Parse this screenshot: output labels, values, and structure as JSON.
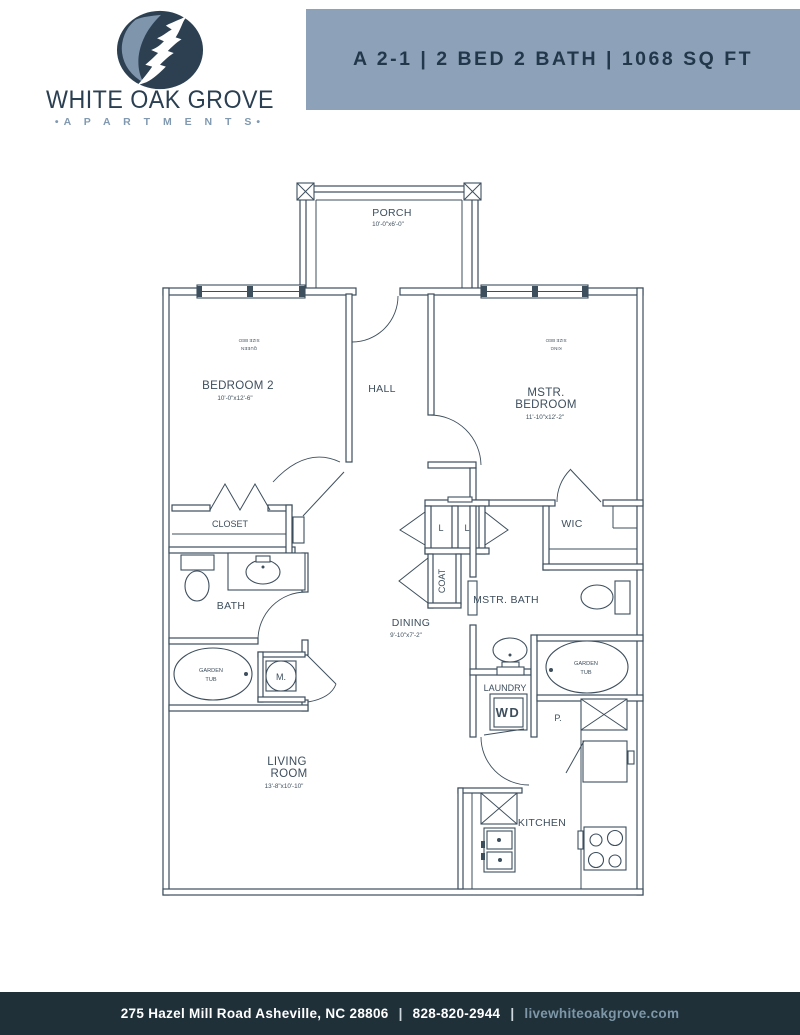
{
  "header": {
    "logo": {
      "name_line": "WHITE OAK GROVE",
      "sub_line": "•A P A R T M E N T S•",
      "name_color": "#2b3f52",
      "sub_color": "#8099b0",
      "leaf_dark": "#2c4052",
      "leaf_light": "#7f95ac"
    },
    "banner": {
      "title": "A 2-1 | 2 BED 2 BATH | 1068 SQ FT",
      "bg_color": "#8da1b8",
      "text_color": "#22384a"
    }
  },
  "floorplan": {
    "line_color": "#3d4e5d",
    "porch": {
      "label": "PORCH",
      "dims": "10'-0\"x6'-0\""
    },
    "bedroom2": {
      "label": "BEDROOM 2",
      "dims": "10'-0\"x12'-6\"",
      "bed_note_line1": "SIZE BED",
      "bed_note_line2": "QUEEN"
    },
    "mstr_bedroom": {
      "label_line1": "MSTR.",
      "label_line2": "BEDROOM",
      "dims": "11'-10\"x12'-2\"",
      "bed_note_line1": "SIZE BED",
      "bed_note_line2": "KING"
    },
    "hall": {
      "label": "HALL"
    },
    "closet": {
      "label": "CLOSET"
    },
    "bath": {
      "label": "BATH"
    },
    "dining": {
      "label": "DINING",
      "dims": "9'-10\"x7'-2\""
    },
    "living_room": {
      "label_line1": "LIVING",
      "label_line2": "ROOM",
      "dims": "13'-8\"x10'-10\""
    },
    "mstr_bath": {
      "label": "MSTR. BATH"
    },
    "wic": {
      "label": "WIC"
    },
    "coat": {
      "label": "COAT"
    },
    "linen1": {
      "label": "L"
    },
    "linen2": {
      "label": "L"
    },
    "laundry": {
      "label": "LAUNDRY",
      "wd_label": "WD"
    },
    "garden_tub_left": {
      "line1": "GARDEN",
      "line2": "TUB"
    },
    "garden_tub_right": {
      "line1": "GARDEN",
      "line2": "TUB"
    },
    "mech": {
      "label": "M."
    },
    "pantry": {
      "label": "P."
    },
    "kitchen": {
      "label": "KITCHEN"
    }
  },
  "footer": {
    "address": "275 Hazel Mill Road Asheville, NC 28806",
    "phone": "828-820-2944",
    "website": "livewhiteoakgrove.com",
    "separator": "|",
    "bg_color": "#1f3039",
    "text_color": "#ffffff",
    "link_color": "#7d97a8"
  }
}
